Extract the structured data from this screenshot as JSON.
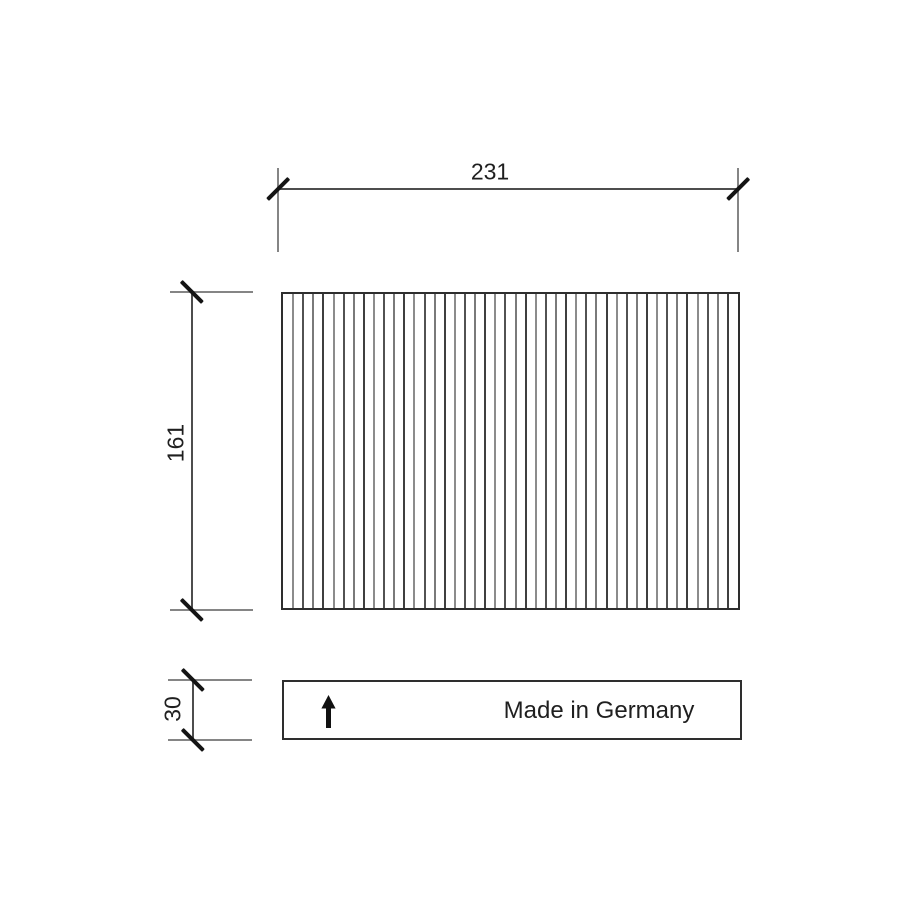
{
  "dimensions": {
    "width": "231",
    "height": "161",
    "depth": "30"
  },
  "label_box": {
    "text": "Made in Germany",
    "arrow_icon": "up-arrow"
  },
  "filter": {
    "pleat_count": 44,
    "pleat_shades": [
      "#3f3f3f",
      "#8c8c8c",
      "#525252",
      "#7a7a7a"
    ]
  },
  "colors": {
    "line": "#4d4d4d",
    "extension_line": "#858585",
    "tick": "#141414",
    "text": "#1f1f1f",
    "border": "#2e2e2e",
    "background": "#ffffff",
    "arrow": "#111111"
  }
}
